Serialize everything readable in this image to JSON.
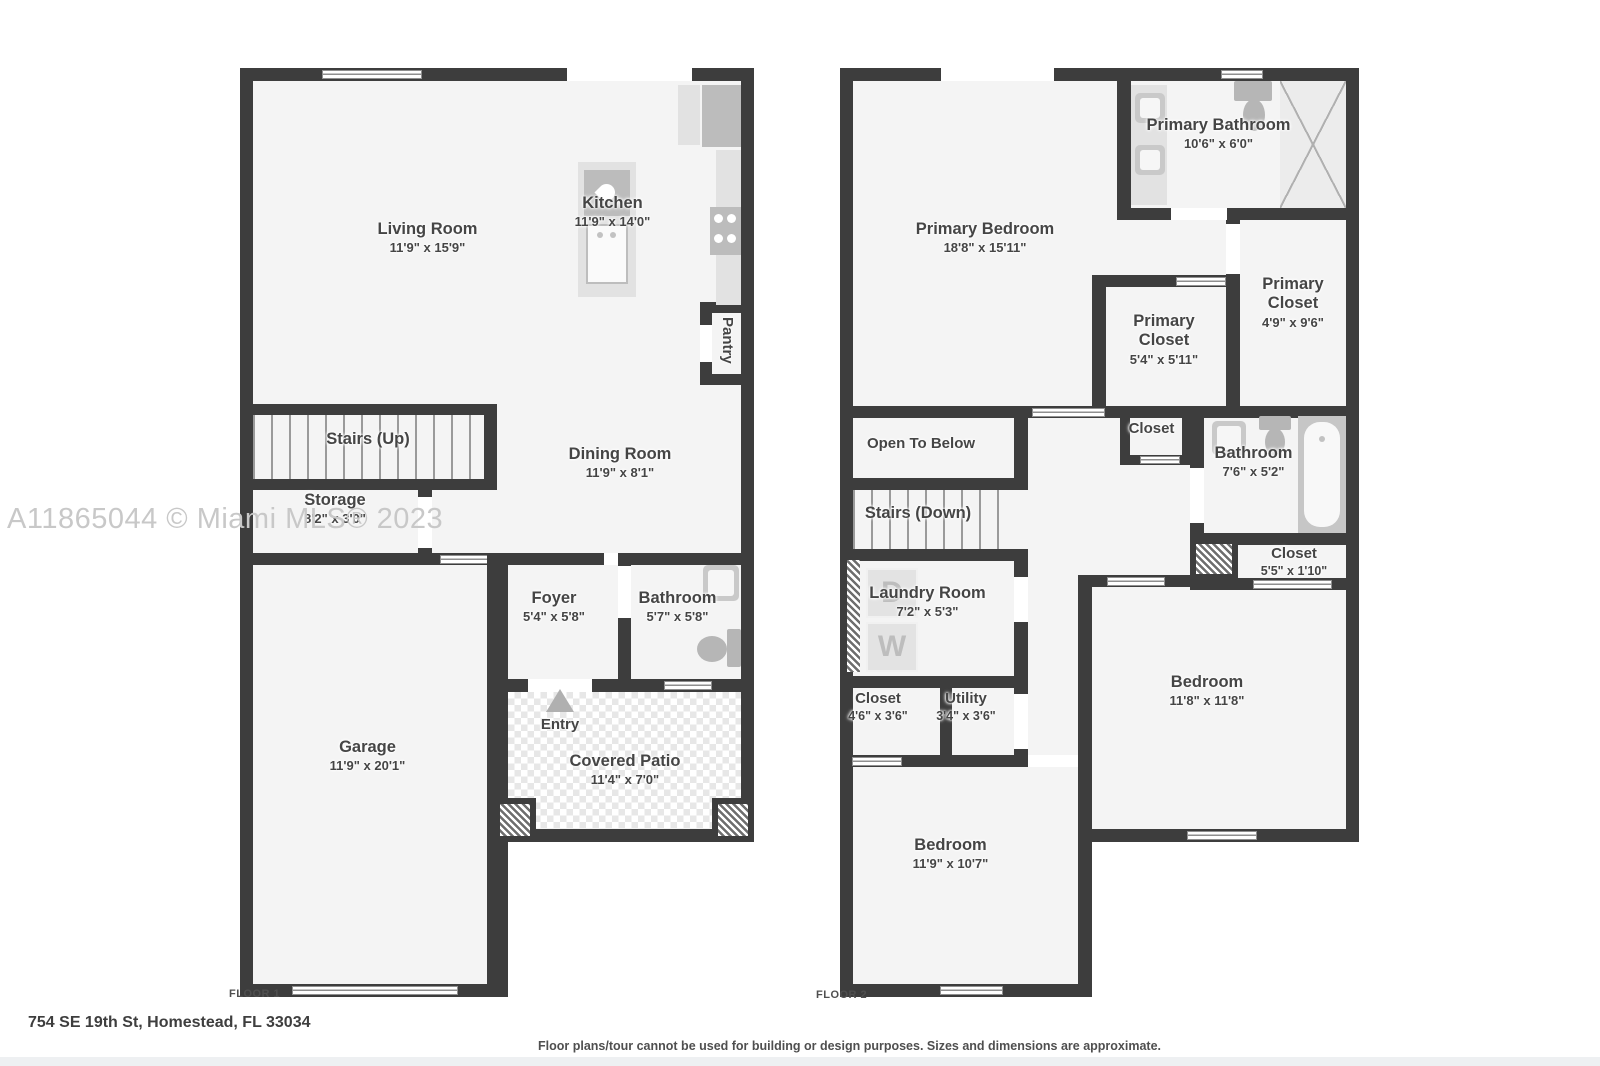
{
  "watermark": "A11865044 © Miami MLS® 2023",
  "address": "754 SE 19th St, Homestead, FL 33034",
  "disclaimer": "Floor plans/tour cannot be used for building or design purposes. Sizes and dimensions are approximate.",
  "colors": {
    "wall": "#3d3d3d",
    "room_fill": "#f4f4f4",
    "fixture": "#c6c6c6",
    "label_text": "#454545",
    "watermark": "#c8c8c8"
  },
  "floor1": {
    "label": "FLOOR 1",
    "rooms": {
      "living": {
        "name": "Living Room",
        "dims": "11'9\" x 15'9\""
      },
      "kitchen": {
        "name": "Kitchen",
        "dims": "11'9\" x 14'0\""
      },
      "pantry": {
        "name": "Pantry"
      },
      "stairs": {
        "name": "Stairs (Up)"
      },
      "storage": {
        "name": "Storage",
        "dims": "8'2\" x 3'0\""
      },
      "dining": {
        "name": "Dining Room",
        "dims": "11'9\" x 8'1\""
      },
      "foyer": {
        "name": "Foyer",
        "dims": "5'4\" x 5'8\""
      },
      "bathroom": {
        "name": "Bathroom",
        "dims": "5'7\" x 5'8\""
      },
      "garage": {
        "name": "Garage",
        "dims": "11'9\" x 20'1\""
      },
      "entry": {
        "name": "Entry"
      },
      "patio": {
        "name": "Covered Patio",
        "dims": "11'4\" x 7'0\""
      }
    }
  },
  "floor2": {
    "label": "FLOOR 2",
    "rooms": {
      "primary_bedroom": {
        "name": "Primary Bedroom",
        "dims": "18'8\" x 15'11\""
      },
      "primary_bathroom": {
        "name": "Primary Bathroom",
        "dims": "10'6\" x 6'0\""
      },
      "primary_closet_right": {
        "name": "Primary Closet",
        "dims": "4'9\" x 9'6\""
      },
      "primary_closet_left": {
        "name": "Primary Closet",
        "dims": "5'4\" x 5'11\""
      },
      "open_to_below": {
        "name": "Open To Below"
      },
      "stairs": {
        "name": "Stairs (Down)"
      },
      "hall_closet": {
        "name": "Closet"
      },
      "bathroom": {
        "name": "Bathroom",
        "dims": "7'6\" x 5'2\""
      },
      "linen_closet": {
        "name": "Closet",
        "dims": "5'5\" x 1'10\""
      },
      "laundry": {
        "name": "Laundry Room",
        "dims": "7'2\" x 5'3\"",
        "dryer": "D",
        "washer": "W"
      },
      "closet": {
        "name": "Closet",
        "dims": "4'6\" x 3'6\""
      },
      "utility": {
        "name": "Utility",
        "dims": "3'4\" x 3'6\""
      },
      "bedroom_right": {
        "name": "Bedroom",
        "dims": "11'8\" x 11'8\""
      },
      "bedroom_left": {
        "name": "Bedroom",
        "dims": "11'9\" x 10'7\""
      }
    }
  }
}
